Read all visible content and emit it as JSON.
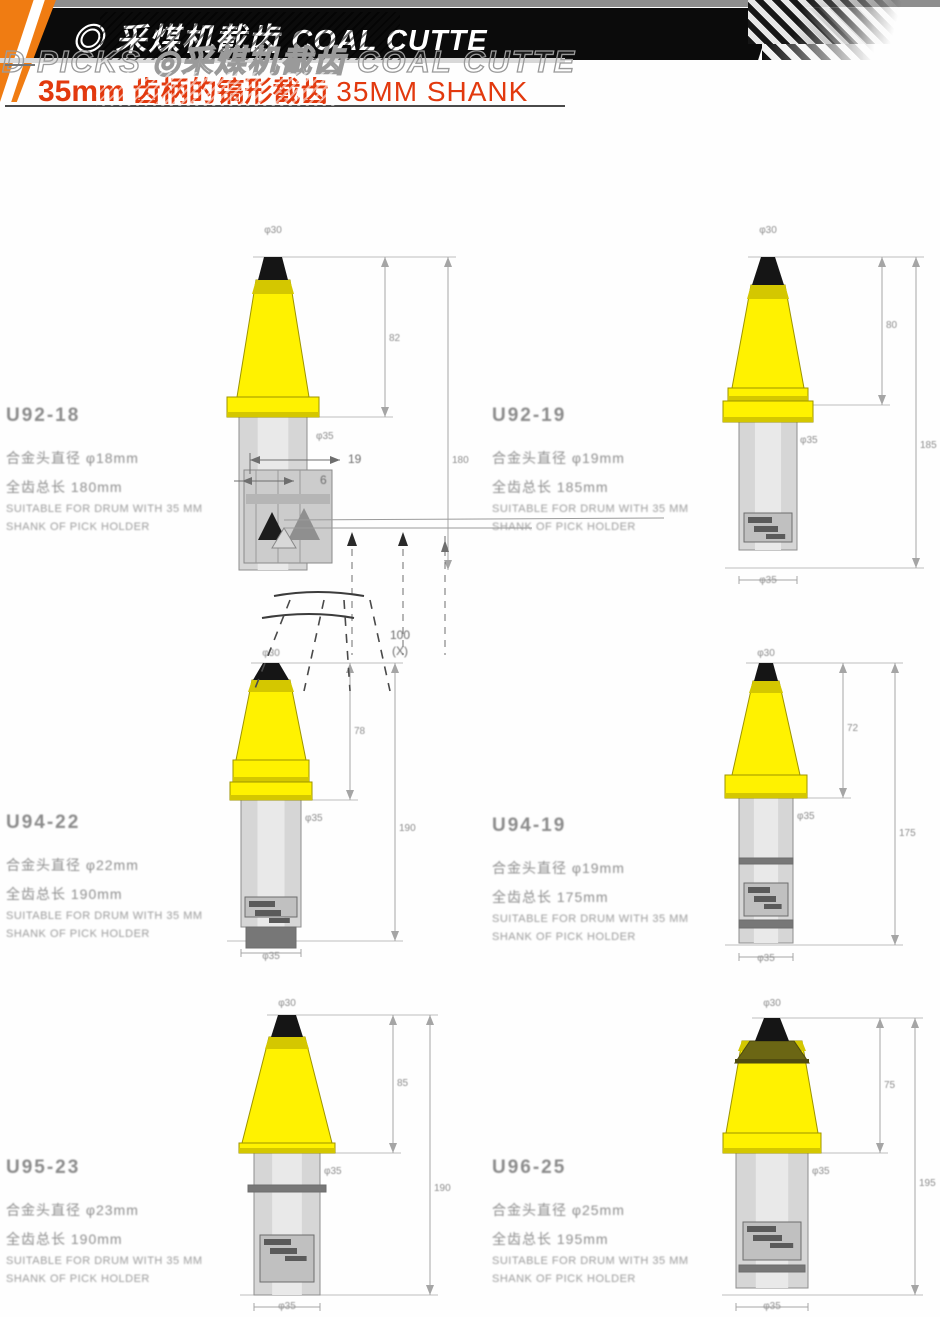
{
  "header": {
    "logo_glyph": "◎",
    "banner_title_cn": "采煤机截齿",
    "banner_title_en": "COAL CUTTE",
    "ghost_text": "D PICKS ◎采煤机截齿 COAL CUTTE",
    "subtitle_mm": "35mm",
    "subtitle_cn": " 齿柄的镐形截齿 ",
    "subtitle_en": "35MM SHANK",
    "colors": {
      "banner": "#0b0b0b",
      "orange": "#f07c12",
      "red": "#e2390e"
    }
  },
  "inset": {
    "dim_19": "19",
    "dim_6": "6",
    "dim_100": "100",
    "dim_x": "(X)"
  },
  "products": [
    {
      "code": "U92-18",
      "spec1": "合金头直径 φ18mm",
      "spec2": "全齿总长 180mm",
      "note1": "SUITABLE FOR DRUM WITH 35 MM",
      "note2": "SHANK OF PICK HOLDER",
      "dims": {
        "top": "φ30",
        "cone": "82",
        "overall": "180",
        "shank": "φ35",
        "bottom": "φ35"
      }
    },
    {
      "code": "U92-19",
      "spec1": "合金头直径 φ19mm",
      "spec2": "全齿总长 185mm",
      "note1": "SUITABLE FOR DRUM WITH 35 MM",
      "note2": "SHANK OF PICK HOLDER",
      "dims": {
        "top": "φ30",
        "cone": "80",
        "overall": "185",
        "shank": "φ35",
        "bottom": "φ35"
      }
    },
    {
      "code": "U94-22",
      "spec1": "合金头直径 φ22mm",
      "spec2": "全齿总长 190mm",
      "note1": "SUITABLE FOR DRUM WITH 35 MM",
      "note2": "SHANK OF PICK HOLDER",
      "dims": {
        "top": "φ30",
        "cone": "78",
        "overall": "190",
        "shank": "φ35",
        "bottom": "φ35"
      }
    },
    {
      "code": "U94-19",
      "spec1": "合金头直径 φ19mm",
      "spec2": "全齿总长 175mm",
      "note1": "SUITABLE FOR DRUM WITH 35 MM",
      "note2": "SHANK OF PICK HOLDER",
      "dims": {
        "top": "φ30",
        "cone": "72",
        "overall": "175",
        "shank": "φ35",
        "bottom": "φ35"
      }
    },
    {
      "code": "U95-23",
      "spec1": "合金头直径 φ23mm",
      "spec2": "全齿总长 190mm",
      "note1": "SUITABLE FOR DRUM WITH 35 MM",
      "note2": "SHANK OF PICK HOLDER",
      "dims": {
        "top": "φ30",
        "cone": "85",
        "overall": "190",
        "shank": "φ35",
        "bottom": "φ35"
      }
    },
    {
      "code": "U96-25",
      "spec1": "合金头直径 φ25mm",
      "spec2": "全齿总长 195mm",
      "note1": "SUITABLE FOR DRUM WITH 35 MM",
      "note2": "SHANK OF PICK HOLDER",
      "dims": {
        "top": "φ30",
        "cone": "75",
        "overall": "195",
        "shank": "φ35",
        "bottom": "φ35"
      }
    }
  ]
}
